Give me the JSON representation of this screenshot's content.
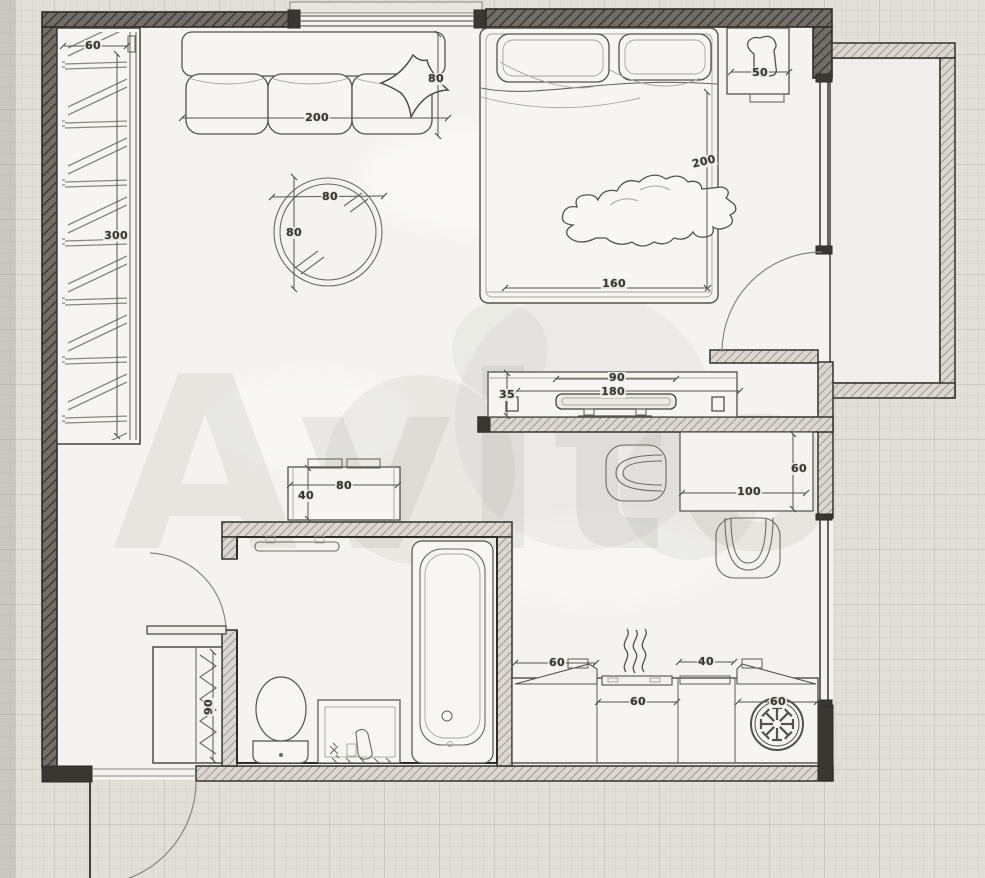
{
  "watermark": {
    "text": "Avito"
  },
  "dimensions": {
    "wardrobe_depth": "60",
    "wardrobe_length": "300",
    "sofa_length": "200",
    "sofa_depth": "80",
    "table_width": "80",
    "table_height": "80",
    "bed_length": "200",
    "bed_width": "160",
    "nightstand_width": "50",
    "tv_width": "90",
    "tv_stand_length": "180",
    "tv_stand_depth": "35",
    "desk_depth": "60",
    "desk_length": "100",
    "dresser_width": "80",
    "dresser_depth": "40",
    "hallway_unit_length": "90",
    "kitchen_upper_left": "60",
    "kitchen_upper_right": "40",
    "kitchen_base_center": "60",
    "kitchen_base_right": "60"
  },
  "colors": {
    "paper": "#e2dfd8",
    "floor": "#f4f3ef",
    "ink": "#3a3733",
    "dim_text": "#3b3833"
  }
}
